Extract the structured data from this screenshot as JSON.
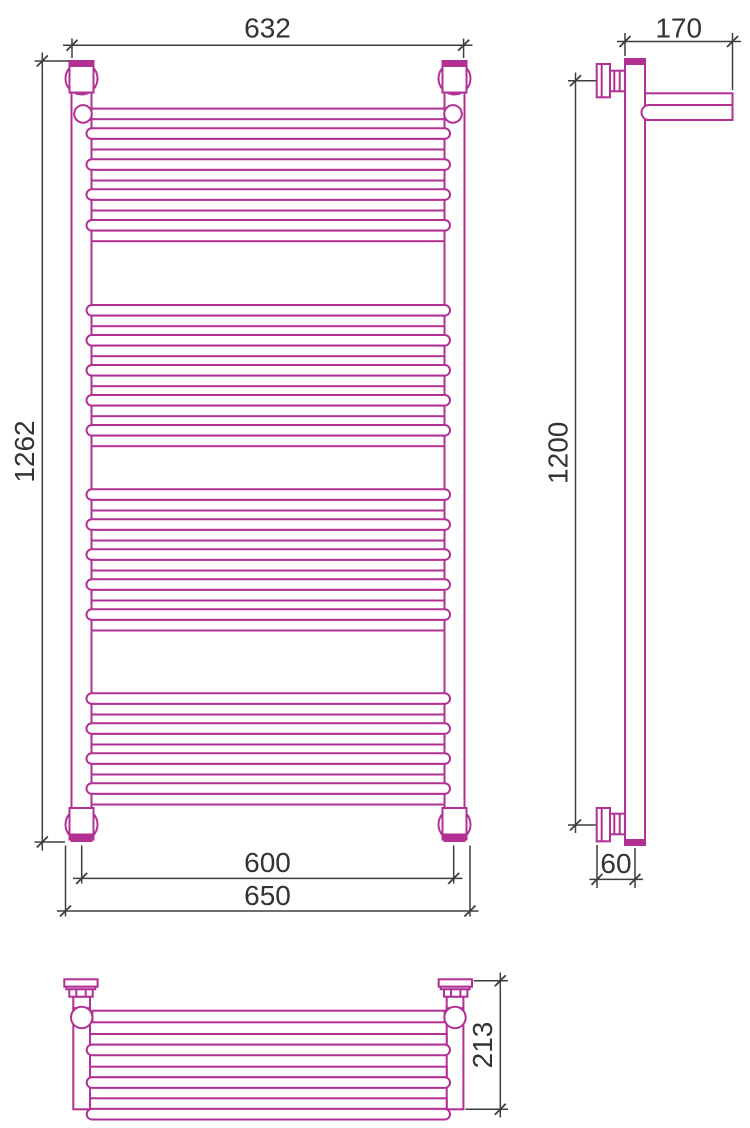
{
  "title": "Towel radiator technical drawing",
  "colors": {
    "outline": "#b23093",
    "dimension": "#3e3e3e",
    "text": "#333333"
  },
  "dimensions": {
    "front": {
      "top_width": "632",
      "height": "1262",
      "axis_width": "600",
      "overall_width": "650"
    },
    "side": {
      "top_depth": "170",
      "mount_height": "1200",
      "wall_offset": "60"
    },
    "plan": {
      "depth": "213"
    }
  },
  "geometry": {
    "front_pair_tops": [
      128.3,
      159.3,
      189.3,
      220.0,
      305.0,
      335.0,
      365.0,
      395.0,
      425.0,
      489.3,
      519.3,
      549.3,
      579.3,
      609.3,
      693.3,
      723.3,
      753.3,
      783.3
    ],
    "plan_pair_tops": [
      1034.0,
      1066.7,
      1098.3
    ]
  }
}
